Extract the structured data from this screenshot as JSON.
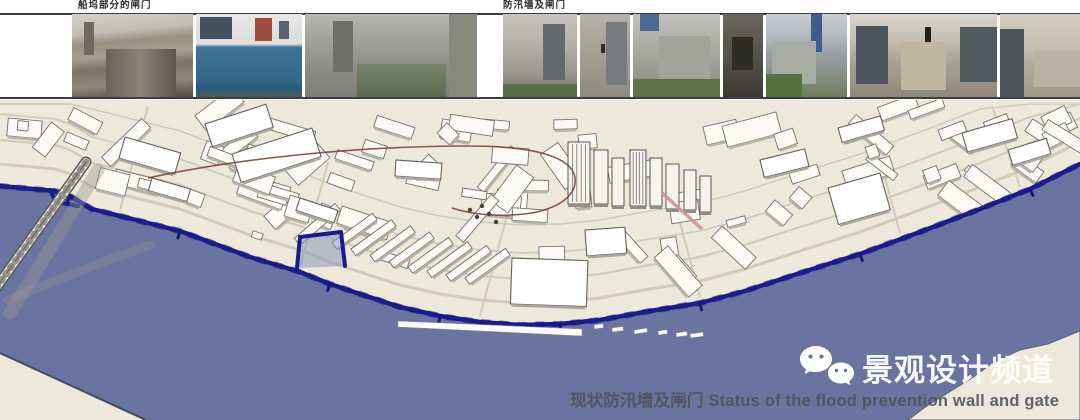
{
  "photo_strip": {
    "group1_label": "船坞部分的闸门",
    "group2_label": "防汛墙及闸门"
  },
  "caption": {
    "title": "现状防汛墙及闸门 Status of the flood prevention wall and gate"
  },
  "watermark": {
    "icon": "wechat-icon",
    "channel_name": "景观设计频道"
  },
  "colors": {
    "land": "#ece8da",
    "water": "#6974a0",
    "flood_wall": "#1b1b90",
    "flood_wall_dark": "#0e0e62",
    "route_red": "#7d3a31",
    "road_pink": "#d4918f",
    "building_fill": "#fbfaf5",
    "building_stroke": "#74726c",
    "title_text": "#4d525b",
    "watermark_text": "#ffffff"
  }
}
